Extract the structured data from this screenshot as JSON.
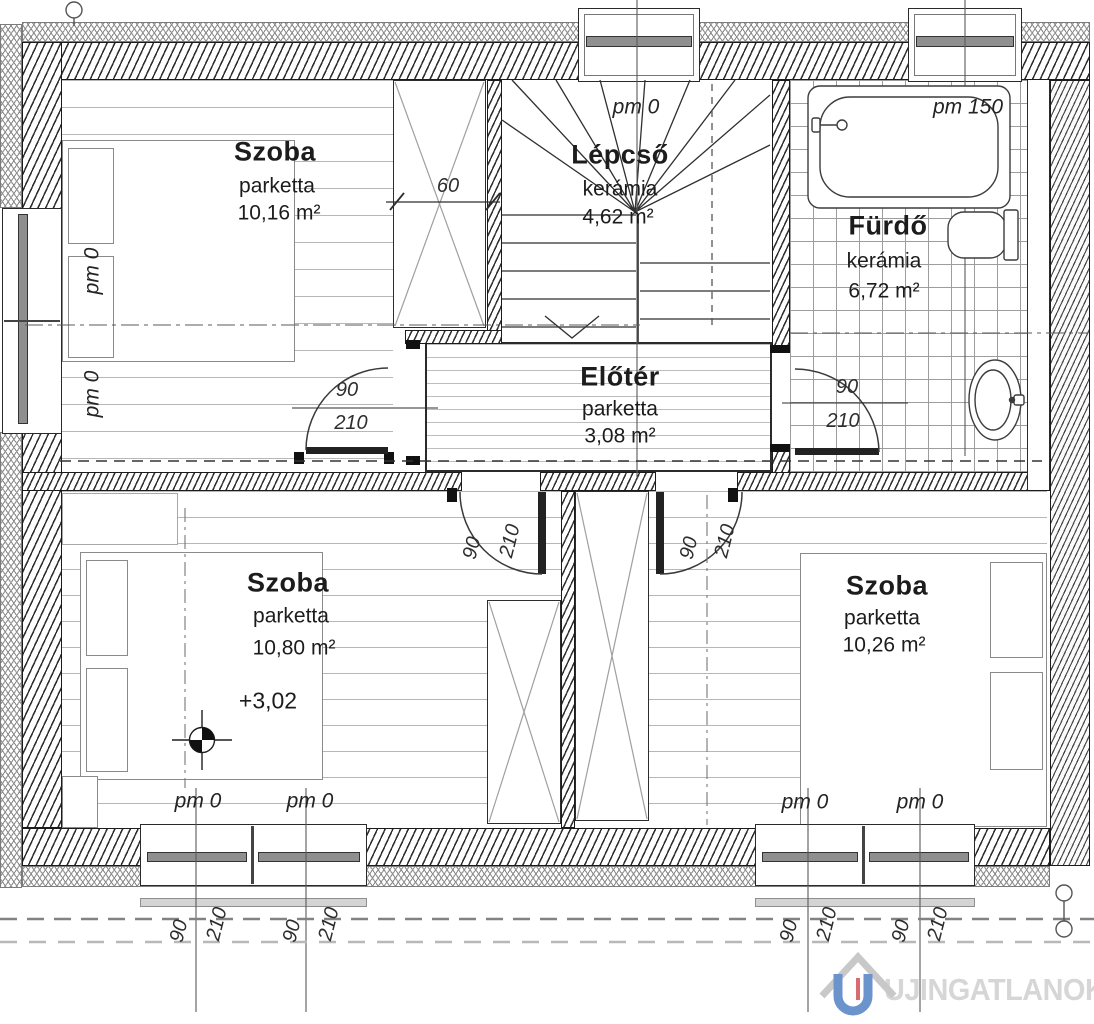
{
  "meta": {
    "type": "floor-plan",
    "language": "hu"
  },
  "rooms": {
    "szoba_top_left": {
      "name": "Szoba",
      "floor_material": "parketta",
      "area": "10,16 m²"
    },
    "lepcso": {
      "name": "Lépcső",
      "floor_material": "kerámia",
      "area": "4,62 m²"
    },
    "furdo": {
      "name": "Fürdő",
      "floor_material": "kerámia",
      "area": "6,72 m²"
    },
    "eloter": {
      "name": "Előtér",
      "floor_material": "parketta",
      "area": "3,08 m²"
    },
    "szoba_bottom_left": {
      "name": "Szoba",
      "floor_material": "parketta",
      "area": "10,80 m²",
      "level_mark": "+3,02"
    },
    "szoba_bottom_right": {
      "name": "Szoba",
      "floor_material": "parketta",
      "area": "10,26 m²"
    }
  },
  "annotations": {
    "parapet_zero": "pm 0",
    "parapet_150": "pm 150",
    "cabinet_depth": "60",
    "door_width": "90",
    "door_height": "210"
  },
  "watermark": {
    "text": "UJINGATLANOK.HU"
  },
  "colors": {
    "line": "#2b2b2b",
    "parquet_line": "#b7b7b7",
    "tile_line": "#9d9d9d",
    "watermark_text": "#d6d6d6",
    "logo_blue": "#6b93cc",
    "logo_red": "#d96a70",
    "logo_roof": "#c8c8c8"
  }
}
